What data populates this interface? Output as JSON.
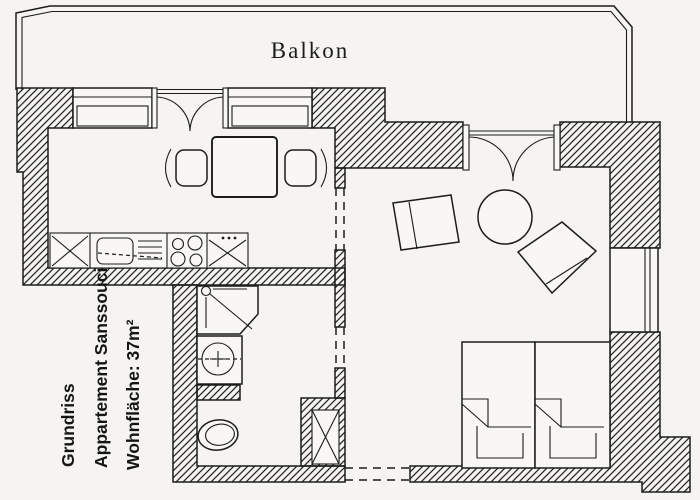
{
  "document": {
    "kind": "apartment floor plan (scanned)",
    "labels": {
      "balcony": "Balkon",
      "title_line1": "Grundriss",
      "title_line2": "Appartement Sanssouci",
      "title_line3": "Wohnfläche: 37m²"
    },
    "area_value": "37m²",
    "colors": {
      "ink": "#1c1c1c",
      "paper": "#f5f4f0",
      "wall_hatch": "#262626"
    },
    "fixtures": [
      "balcony-railing",
      "balcony-door-double",
      "french-door-double",
      "window",
      "kitchen-counter",
      "kitchen-sink",
      "kitchen-stove",
      "kitchen-cabinet",
      "dining-table",
      "dining-chair",
      "shower",
      "washbasin",
      "toilet",
      "ventilation-shaft",
      "armchair",
      "round-table",
      "lounge-chair",
      "twin-bed",
      "entrance-opening",
      "passage-opening"
    ]
  }
}
